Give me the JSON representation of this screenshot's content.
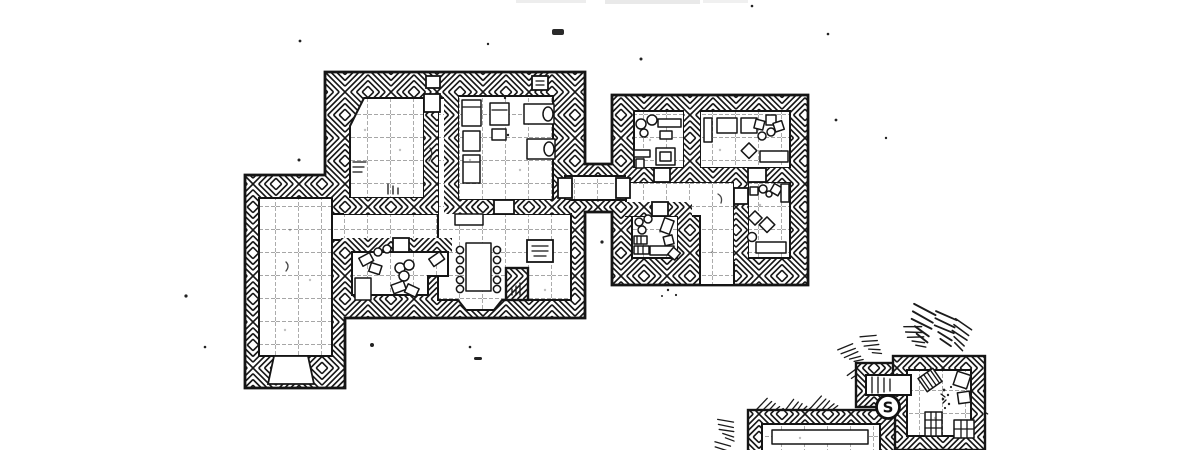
{
  "map": {
    "type": "hand-drawn dungeon floor plan",
    "ink_color": "#151515",
    "paper_color": "#ffffff",
    "grid_size_px": 23,
    "secret_door_marker": {
      "label": "S",
      "meaning": "secret door"
    },
    "title_fragment": "cropped title smudge at top edge",
    "buildings": [
      {
        "id": "west-manor",
        "rooms": [
          {
            "name": "study",
            "features": [
              "chamfered corner",
              "steps",
              "door to hall"
            ]
          },
          {
            "name": "bunk-room",
            "features": [
              "two bunks",
              "table",
              "two beds",
              "hearth nook",
              "south door"
            ]
          },
          {
            "name": "great-hall",
            "features": [
              "long table",
              "ten stools",
              "hearth",
              "bench"
            ]
          },
          {
            "name": "kitchen",
            "features": [
              "round table",
              "stools",
              "cupboard",
              "benches",
              "north door"
            ]
          },
          {
            "name": "west-wing-hall",
            "features": [
              "long empty hall",
              "south exit door"
            ]
          },
          {
            "name": "east-corridor",
            "features": [
              "door each end",
              "links to east house"
            ]
          }
        ]
      },
      {
        "id": "east-house",
        "rooms": [
          {
            "name": "northwest-room",
            "features": [
              "round stools",
              "bench",
              "nested table"
            ]
          },
          {
            "name": "northeast-room",
            "features": [
              "tables",
              "crates",
              "stools",
              "long bench"
            ]
          },
          {
            "name": "southwest-room",
            "features": [
              "stools",
              "firewood pile",
              "benches"
            ]
          },
          {
            "name": "southeast-room",
            "features": [
              "crates",
              "stools",
              "table"
            ]
          },
          {
            "name": "south-passage",
            "features": [
              "exit to outside"
            ]
          }
        ]
      },
      {
        "id": "south-cellar",
        "rooms": [
          {
            "name": "store-room",
            "features": [
              "tipped crate",
              "debris",
              "crates",
              "barrel boxes"
            ]
          },
          {
            "name": "stair-passage",
            "features": [
              "steps",
              "secret door S"
            ]
          },
          {
            "name": "south-chamber",
            "features": [
              "long table",
              "cut off at map edge"
            ]
          }
        ]
      }
    ]
  }
}
